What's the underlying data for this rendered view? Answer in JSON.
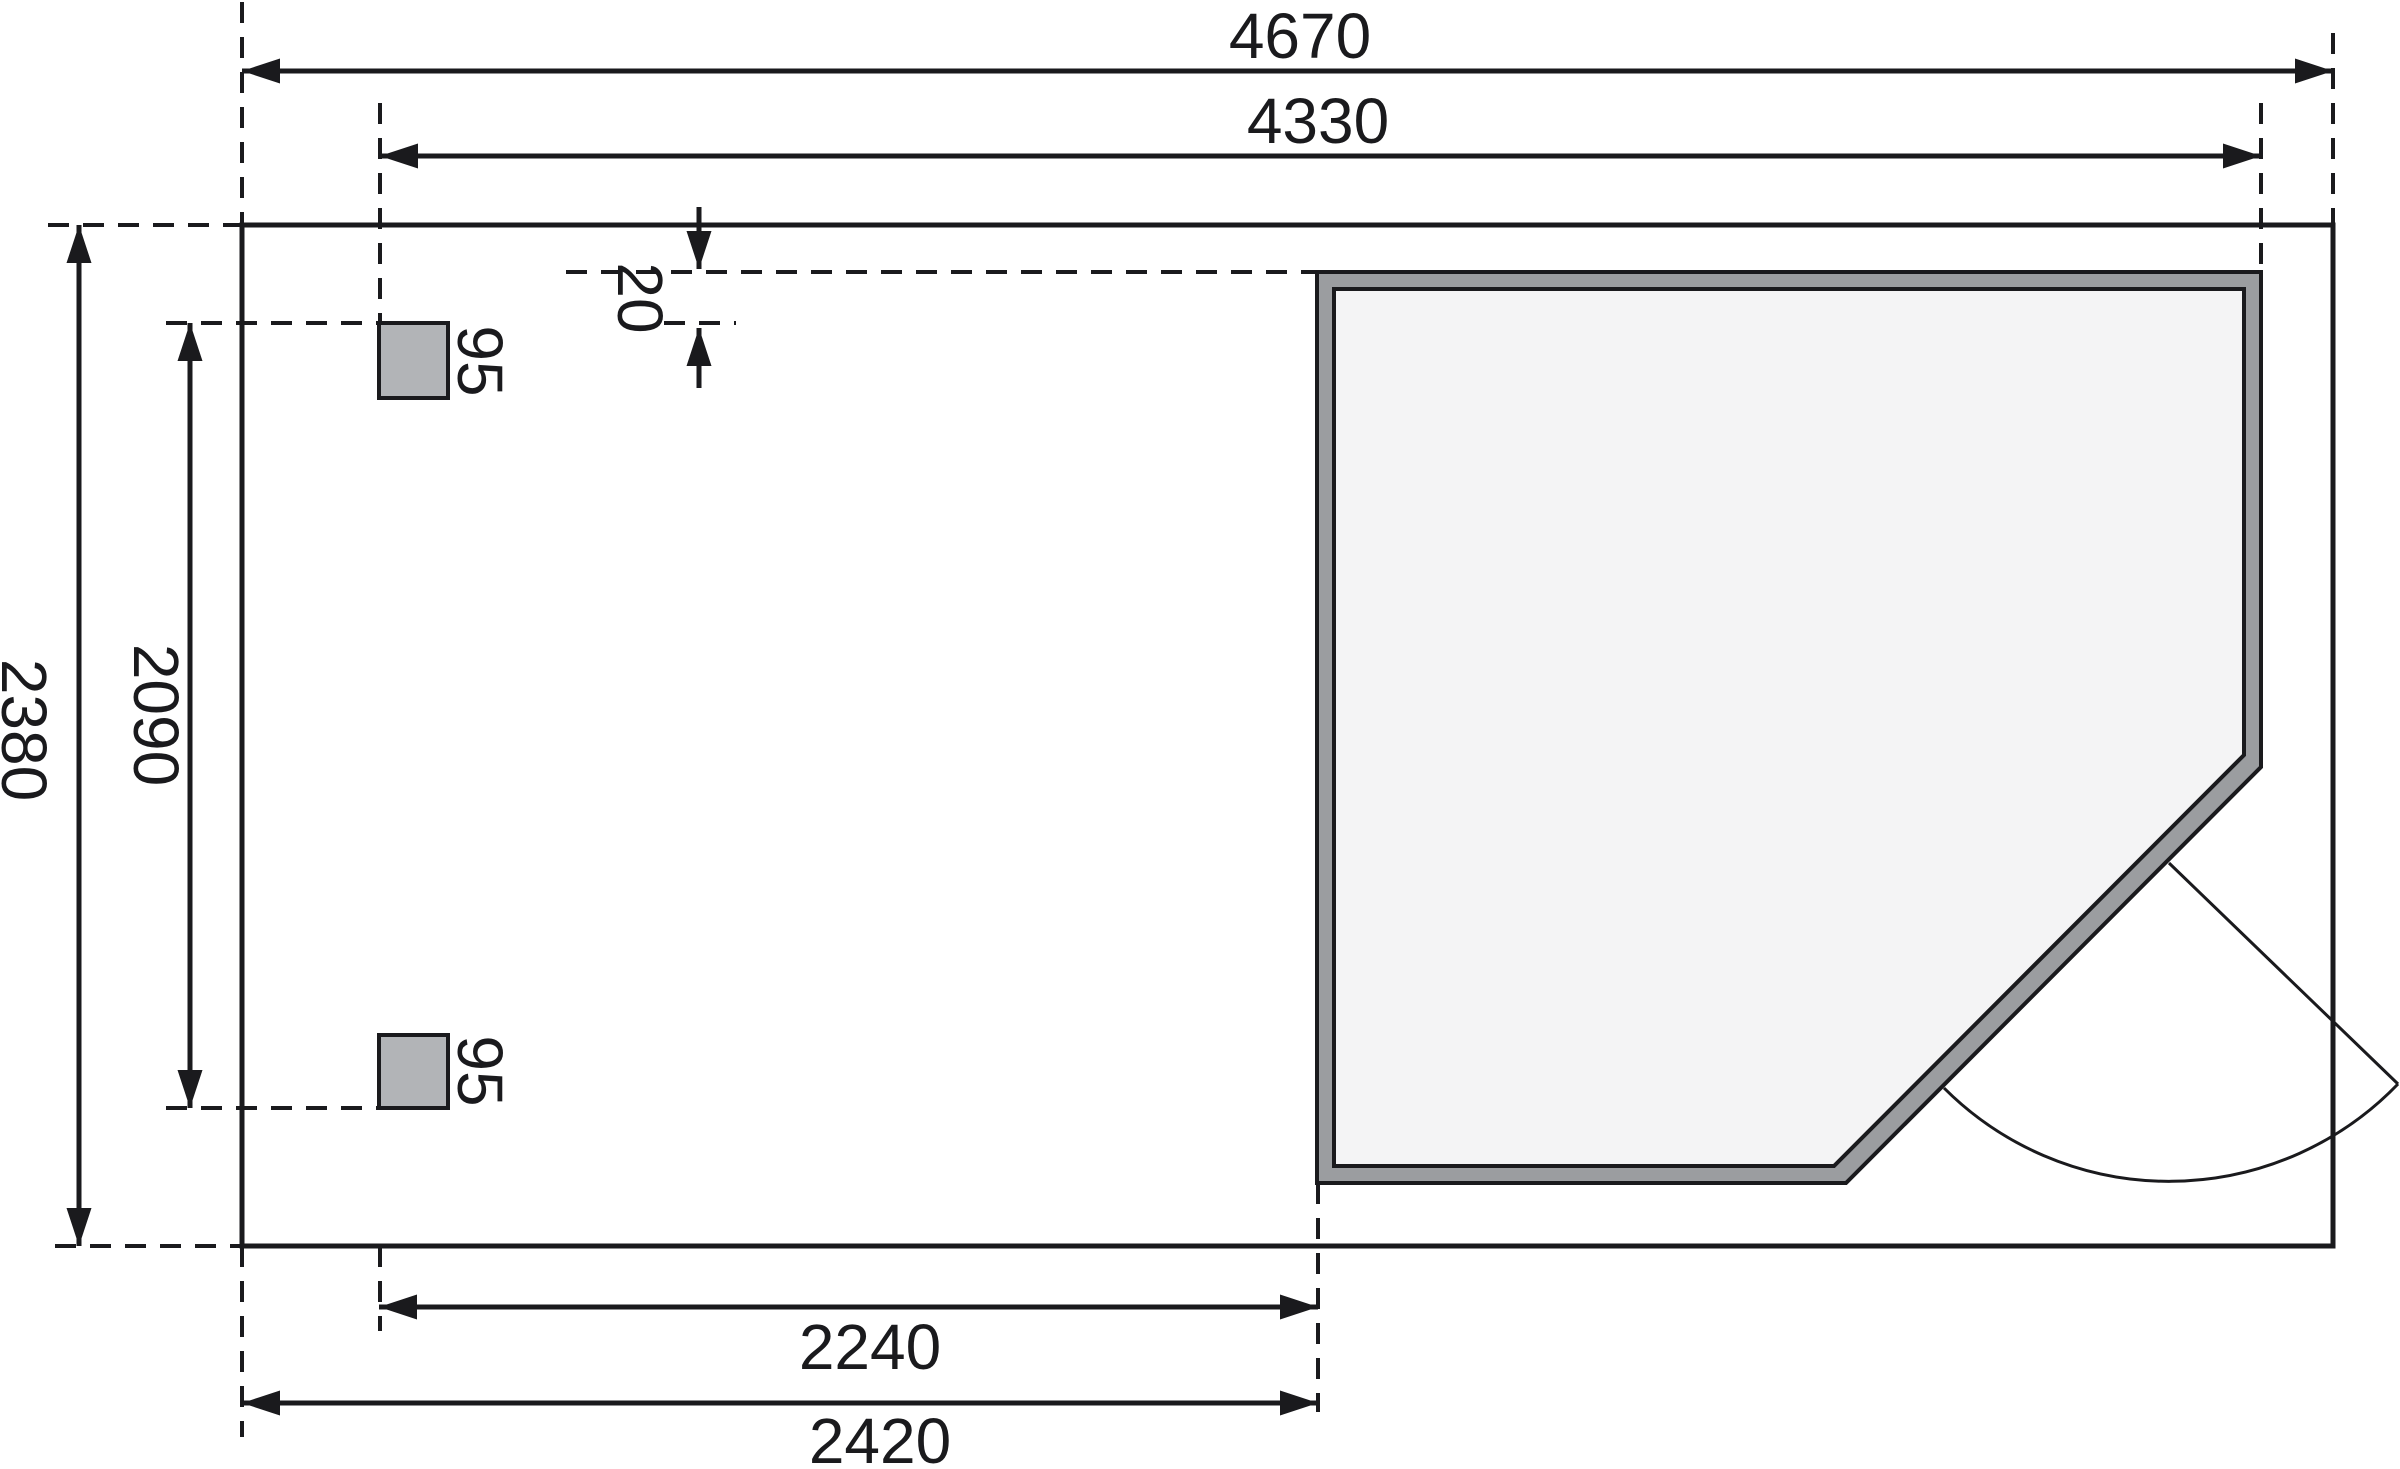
{
  "drawing": {
    "canvas": {
      "width": 2400,
      "height": 1469,
      "background": "#ffffff"
    },
    "colors": {
      "line": "#1a1a1d",
      "text": "#1a1a1d",
      "wall_fill": "#9b9da0",
      "interior_fill": "#f4f4f5",
      "post_fill": "#b2b4b7"
    },
    "style": {
      "solid_stroke": 5,
      "wall_stroke": 4,
      "dash_stroke": 4,
      "dim_stroke": 5,
      "door_stroke": 3,
      "dash_array": "21 14",
      "arrow_length": 38,
      "arrow_half_width": 12.5,
      "font_size": 64
    },
    "plot_rect": {
      "x": 242,
      "y": 225,
      "w": 2091,
      "h": 1021
    },
    "building": {
      "outer_points": "1317,272 2261,272 2261,767 1846,1183 1317,1183",
      "inner_points": "1334,289 2244,289 2244,755 1834,1166 1334,1166"
    },
    "posts": [
      {
        "x": 379,
        "y": 323,
        "w": 69,
        "h": 75
      },
      {
        "x": 379,
        "y": 1035,
        "w": 69,
        "h": 73
      }
    ],
    "door": {
      "leaf": {
        "x1": 2169,
        "y1": 863,
        "x2": 2398,
        "y2": 1084
      },
      "arc_path": "M 2398 1084 A 318 318 0 0 1 1944 1088"
    },
    "dashed_lines": [
      {
        "x1": 242,
        "y1": 2,
        "x2": 242,
        "y2": 225
      },
      {
        "x1": 380,
        "y1": 103,
        "x2": 380,
        "y2": 323
      },
      {
        "x1": 2333,
        "y1": 33,
        "x2": 2333,
        "y2": 225
      },
      {
        "x1": 2261,
        "y1": 103,
        "x2": 2261,
        "y2": 272
      },
      {
        "x1": 242,
        "y1": 1246,
        "x2": 242,
        "y2": 1437
      },
      {
        "x1": 380,
        "y1": 1246,
        "x2": 380,
        "y2": 1331
      },
      {
        "x1": 1318,
        "y1": 1183,
        "x2": 1318,
        "y2": 1412
      },
      {
        "x1": 48,
        "y1": 225,
        "x2": 242,
        "y2": 225
      },
      {
        "x1": 55,
        "y1": 1246,
        "x2": 242,
        "y2": 1246
      },
      {
        "x1": 166,
        "y1": 323,
        "x2": 379,
        "y2": 323
      },
      {
        "x1": 664,
        "y1": 323,
        "x2": 736,
        "y2": 323
      },
      {
        "x1": 166,
        "y1": 1108,
        "x2": 379,
        "y2": 1108
      },
      {
        "x1": 566,
        "y1": 272,
        "x2": 1317,
        "y2": 272
      }
    ],
    "dimension_lines": [
      {
        "x1": 242,
        "y1": 71,
        "x2": 2333,
        "y2": 71,
        "arrows": "both",
        "value": "4670"
      },
      {
        "x1": 380,
        "y1": 156,
        "x2": 2261,
        "y2": 156,
        "arrows": "both",
        "value": "4330"
      },
      {
        "x1": 79,
        "y1": 225,
        "x2": 79,
        "y2": 1246,
        "arrows": "both",
        "value": "2380"
      },
      {
        "x1": 190,
        "y1": 323,
        "x2": 190,
        "y2": 1108,
        "arrows": "both",
        "value": "2090"
      },
      {
        "x1": 379,
        "y1": 1307,
        "x2": 1318,
        "y2": 1307,
        "arrows": "both",
        "value": "2240"
      },
      {
        "x1": 242,
        "y1": 1403,
        "x2": 1318,
        "y2": 1403,
        "arrows": "both",
        "value": "2420"
      },
      {
        "x1": 699,
        "y1": 207,
        "x2": 699,
        "y2": 269,
        "arrows": "end",
        "value": "20"
      },
      {
        "x1": 699,
        "y1": 388,
        "x2": 699,
        "y2": 328,
        "arrows": "end",
        "value": "20"
      }
    ],
    "labels": [
      {
        "text": "4670",
        "x": 1300,
        "y": 36,
        "rotate": 0
      },
      {
        "text": "4330",
        "x": 1318,
        "y": 121,
        "rotate": 0
      },
      {
        "text": "2380",
        "x": 24,
        "y": 730,
        "rotate": 90
      },
      {
        "text": "2090",
        "x": 156,
        "y": 715,
        "rotate": 90
      },
      {
        "text": "95",
        "x": 480,
        "y": 361,
        "rotate": 90
      },
      {
        "text": "95",
        "x": 480,
        "y": 1071,
        "rotate": 90
      },
      {
        "text": "20",
        "x": 640,
        "y": 298,
        "rotate": 90
      },
      {
        "text": "2240",
        "x": 870,
        "y": 1347,
        "rotate": 0
      },
      {
        "text": "2420",
        "x": 880,
        "y": 1441,
        "rotate": 0
      }
    ]
  }
}
